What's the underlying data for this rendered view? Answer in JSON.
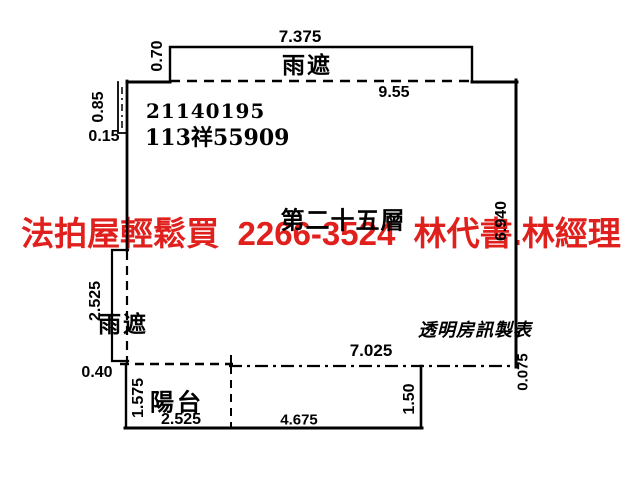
{
  "colors": {
    "watermark_red": "#e0201d",
    "line": "#000000",
    "background": "#ffffff"
  },
  "watermark": {
    "text": "法拍屋輕鬆買  2266-3524  林代書.林經理"
  },
  "plan": {
    "floor_label": "第二十五層",
    "case_number_line1": "21140195",
    "case_number_line2": "113祥55909",
    "maker_credit": "透明房訊製表",
    "labels": {
      "canopy_top": "雨遮",
      "canopy_left": "雨遮",
      "balcony": "陽台"
    },
    "dimensions": {
      "canopy_top_width": "7.375",
      "canopy_top_height": "0.70",
      "unit_top_width": "9.55",
      "notch_height": "0.85",
      "notch_width": "0.15",
      "right_wall_height": "6.940",
      "canopy_left_height": "2.525",
      "canopy_left_width": "0.40",
      "unit_bottom_width": "7.025",
      "right_edge_offset": "0.075",
      "balcony_height": "1.575",
      "balcony_left_width": "2.525",
      "balcony_mid_width": "4.675",
      "balcony_right_height": "1.50"
    }
  }
}
